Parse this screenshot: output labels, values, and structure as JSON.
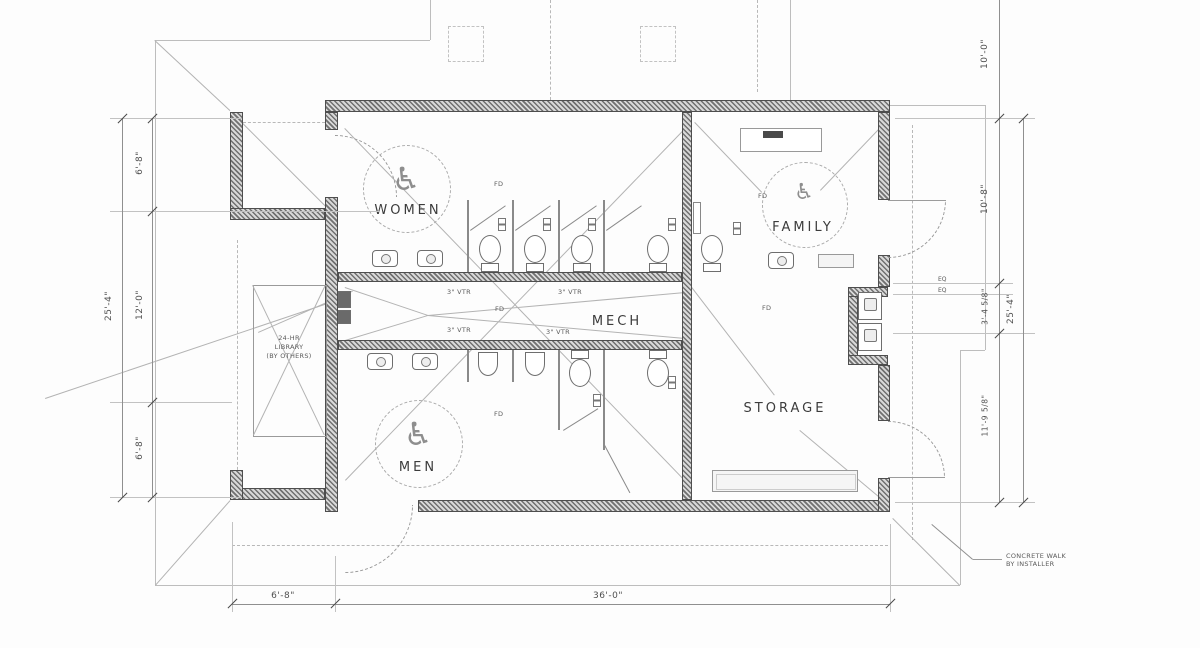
{
  "rooms": {
    "women": "WOMEN",
    "family": "FAMILY",
    "mech": "MECH",
    "men": "MEN",
    "storage": "STORAGE"
  },
  "annotations": {
    "library_line1": "24-HR",
    "library_line2": "LIBRARY",
    "library_line3": "(BY OTHERS)",
    "concrete_walk_line1": "CONCRETE WALK",
    "concrete_walk_line2": "BY INSTALLER",
    "vtr": "3\" VTR",
    "fd": "FD",
    "eq": "EQ"
  },
  "dimensions": {
    "left": {
      "overall": "25'-4\"",
      "segments": [
        "6'-8\"",
        "12'-0\"",
        "6'-8\""
      ]
    },
    "right": {
      "overall": "25'-4\"",
      "segments": [
        "10'-0\"",
        "10'-8\"",
        "3'-4 5/8\"",
        "11'-9 5/8\""
      ]
    },
    "bottom": {
      "segments": [
        "6'-8\"",
        "36'-0\""
      ]
    }
  },
  "symbols": {
    "wheelchair": "♿"
  }
}
